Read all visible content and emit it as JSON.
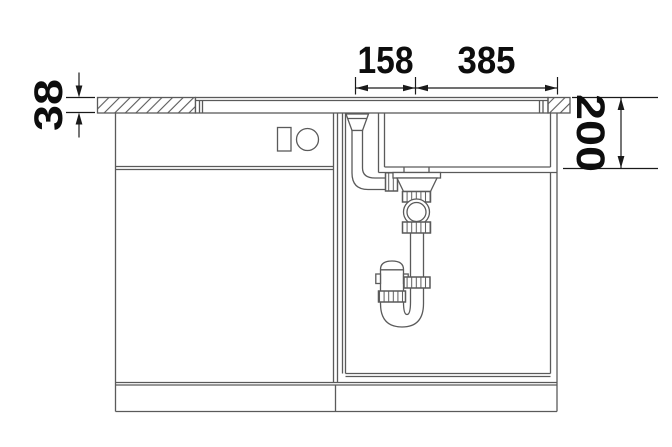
{
  "drawing": {
    "kind": "sink-installation-section-drawing",
    "background": "#ffffff",
    "line_color": "#5a5a5a",
    "dimension_color": "#1a1a1a",
    "text_color": "#0d0d0d"
  },
  "dimensions": {
    "top_left": {
      "label": "158"
    },
    "top_right": {
      "label": "385"
    },
    "left_thickness": {
      "label": "38"
    },
    "right_depth": {
      "label": "200"
    }
  },
  "components": {
    "countertop": "hatched worktop section with sink rim profile",
    "left_cabinet": "cabinet front with drawer, handle rectangle and knob circle",
    "sink_bowl": "bowl cross-section",
    "overflow_pipe": "funnel and elbow pipe to strainer",
    "strainer": "basket strainer with ball joint and knurled nuts",
    "siphon": "S-trap with cleanout plug and union nuts",
    "plinth": "base plinth band"
  }
}
